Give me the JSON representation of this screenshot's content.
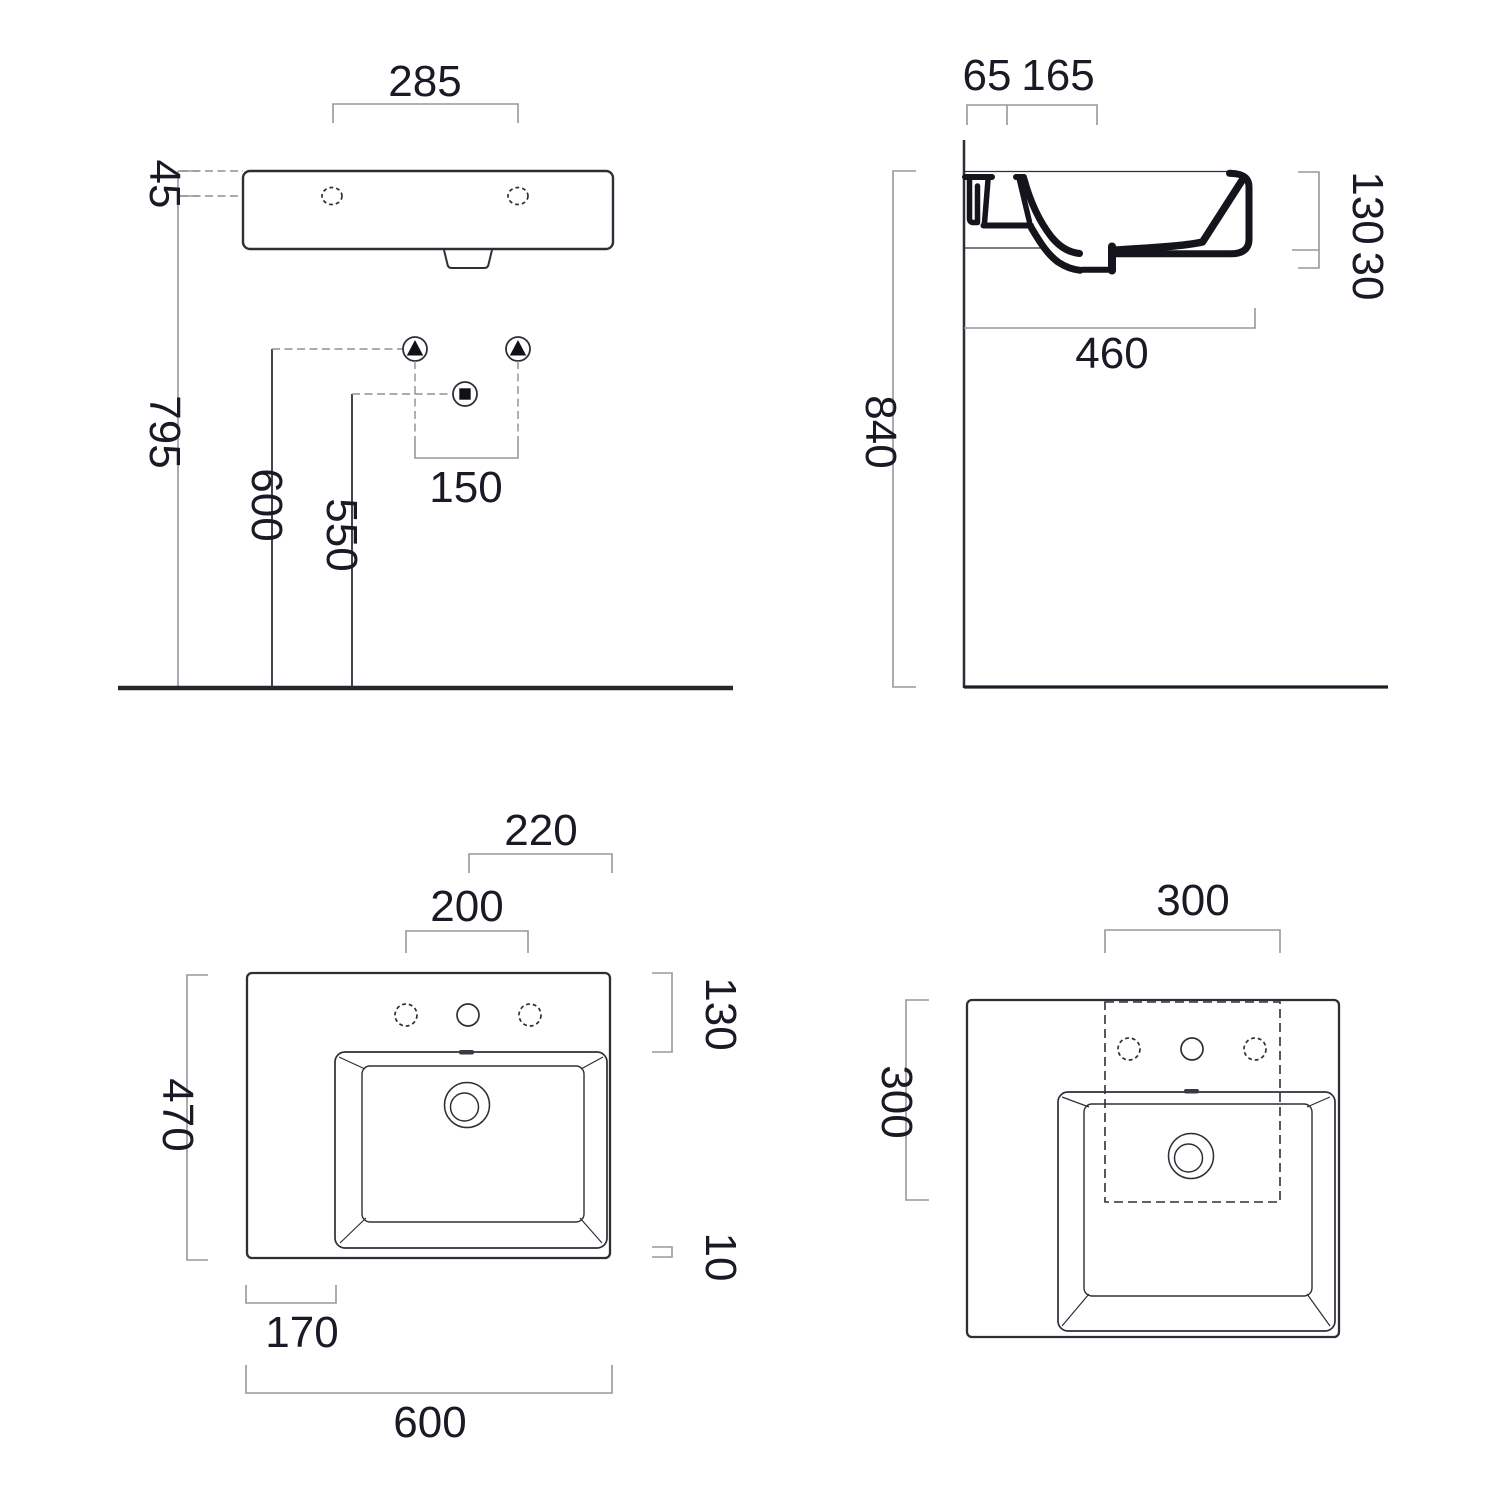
{
  "colors": {
    "line": "#2e2e37",
    "dimension": "#97979d",
    "text": "#1a1a26",
    "section": "#14141c"
  },
  "front": {
    "hole_span": "285",
    "rim_to_holes": "45",
    "floor_to_rim": "795",
    "supply_height": "600",
    "waste_height": "550",
    "supply_span": "150"
  },
  "side": {
    "wall_gap": "65",
    "tap_center": "165",
    "bowl_depth": "130",
    "front_lip": "30",
    "basin_depth": "460",
    "mount_height": "840"
  },
  "plan": {
    "center_to_edge": "220",
    "hole_span": "200",
    "back_depth": "130",
    "total_depth": "470",
    "front_edge": "10",
    "left_shelf": "170",
    "total_width": "600"
  },
  "plan_square": {
    "cutout_width": "300",
    "cutout_depth": "300"
  }
}
